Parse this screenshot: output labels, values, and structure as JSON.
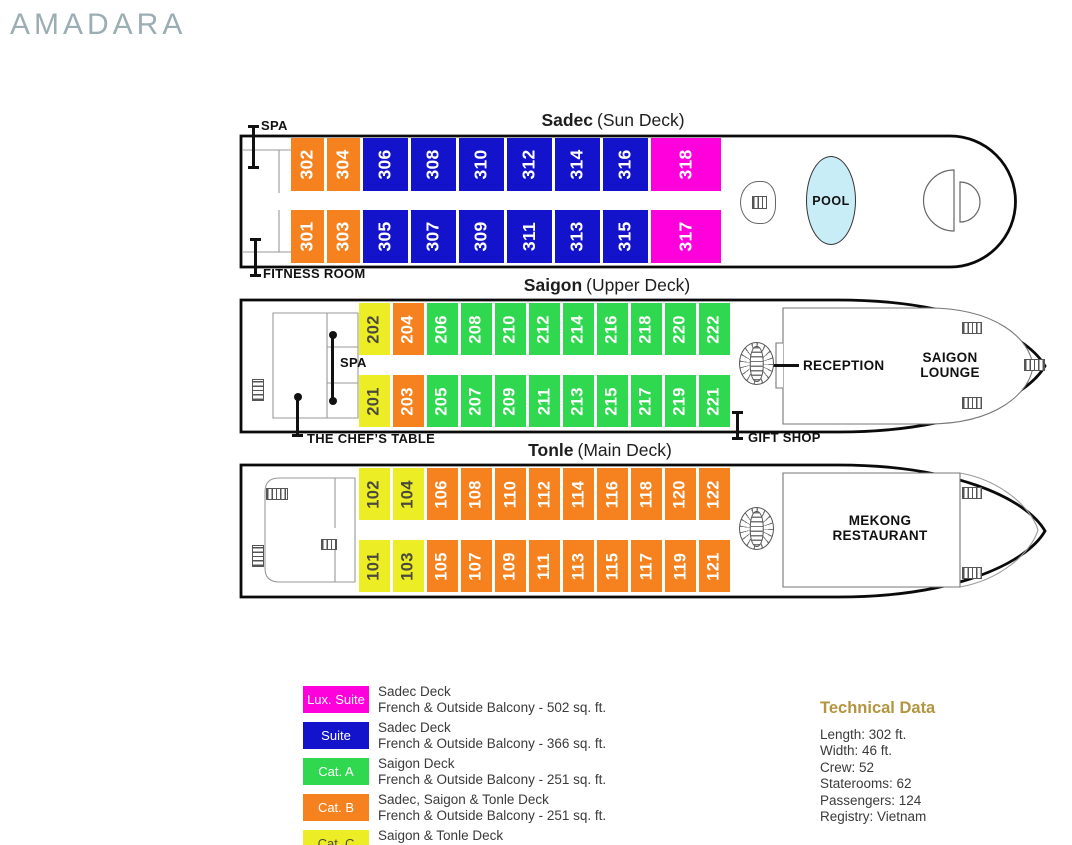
{
  "logo": "AMADARA",
  "colors": {
    "lux": "#FF00DC",
    "suite": "#1313CB",
    "catA": "#30D84F",
    "catB": "#F5821F",
    "catC": "#EDED26",
    "catCtext": "#4A4A3C",
    "pool": "#C9EDF6",
    "logo": "#9BAEB4",
    "gold": "#B3953F"
  },
  "icons": {
    "ladder": "striped-rect-stairs",
    "spiral_staircase": "radial-striped-circle",
    "pool_shape": "ellipse"
  },
  "decks": [
    {
      "name": "Sadec",
      "subtitle": "(Sun Deck)",
      "rooms_top": [
        {
          "num": "302",
          "cat": "catB"
        },
        {
          "num": "304",
          "cat": "catB"
        },
        {
          "num": "306",
          "cat": "suite"
        },
        {
          "num": "308",
          "cat": "suite"
        },
        {
          "num": "310",
          "cat": "suite"
        },
        {
          "num": "312",
          "cat": "suite"
        },
        {
          "num": "314",
          "cat": "suite"
        },
        {
          "num": "316",
          "cat": "suite"
        },
        {
          "num": "318",
          "cat": "lux"
        }
      ],
      "rooms_bottom": [
        {
          "num": "301",
          "cat": "catB"
        },
        {
          "num": "303",
          "cat": "catB"
        },
        {
          "num": "305",
          "cat": "suite"
        },
        {
          "num": "307",
          "cat": "suite"
        },
        {
          "num": "309",
          "cat": "suite"
        },
        {
          "num": "311",
          "cat": "suite"
        },
        {
          "num": "313",
          "cat": "suite"
        },
        {
          "num": "315",
          "cat": "suite"
        },
        {
          "num": "317",
          "cat": "lux"
        }
      ],
      "labels": {
        "spa": "SPA",
        "fitness": "FITNESS ROOM",
        "pool": "POOL"
      }
    },
    {
      "name": "Saigon",
      "subtitle": "(Upper Deck)",
      "rooms_top": [
        {
          "num": "202",
          "cat": "catC"
        },
        {
          "num": "204",
          "cat": "catB"
        },
        {
          "num": "206",
          "cat": "catA"
        },
        {
          "num": "208",
          "cat": "catA"
        },
        {
          "num": "210",
          "cat": "catA"
        },
        {
          "num": "212",
          "cat": "catA"
        },
        {
          "num": "214",
          "cat": "catA"
        },
        {
          "num": "216",
          "cat": "catA"
        },
        {
          "num": "218",
          "cat": "catA"
        },
        {
          "num": "220",
          "cat": "catA"
        },
        {
          "num": "222",
          "cat": "catA"
        }
      ],
      "rooms_bottom": [
        {
          "num": "201",
          "cat": "catC"
        },
        {
          "num": "203",
          "cat": "catB"
        },
        {
          "num": "205",
          "cat": "catA"
        },
        {
          "num": "207",
          "cat": "catA"
        },
        {
          "num": "209",
          "cat": "catA"
        },
        {
          "num": "211",
          "cat": "catA"
        },
        {
          "num": "213",
          "cat": "catA"
        },
        {
          "num": "215",
          "cat": "catA"
        },
        {
          "num": "217",
          "cat": "catA"
        },
        {
          "num": "219",
          "cat": "catA"
        },
        {
          "num": "221",
          "cat": "catA"
        }
      ],
      "labels": {
        "spa": "SPA",
        "chefs_table": "THE CHEF’S TABLE",
        "reception": "RECEPTION",
        "lounge_line1": "SAIGON",
        "lounge_line2": "LOUNGE",
        "gift_shop": "GIFT SHOP"
      }
    },
    {
      "name": "Tonle",
      "subtitle": "(Main Deck)",
      "rooms_top": [
        {
          "num": "102",
          "cat": "catC"
        },
        {
          "num": "104",
          "cat": "catC"
        },
        {
          "num": "106",
          "cat": "catB"
        },
        {
          "num": "108",
          "cat": "catB"
        },
        {
          "num": "110",
          "cat": "catB"
        },
        {
          "num": "112",
          "cat": "catB"
        },
        {
          "num": "114",
          "cat": "catB"
        },
        {
          "num": "116",
          "cat": "catB"
        },
        {
          "num": "118",
          "cat": "catB"
        },
        {
          "num": "120",
          "cat": "catB"
        },
        {
          "num": "122",
          "cat": "catB"
        }
      ],
      "rooms_bottom": [
        {
          "num": "101",
          "cat": "catC"
        },
        {
          "num": "103",
          "cat": "catC"
        },
        {
          "num": "105",
          "cat": "catB"
        },
        {
          "num": "107",
          "cat": "catB"
        },
        {
          "num": "109",
          "cat": "catB"
        },
        {
          "num": "111",
          "cat": "catB"
        },
        {
          "num": "113",
          "cat": "catB"
        },
        {
          "num": "115",
          "cat": "catB"
        },
        {
          "num": "117",
          "cat": "catB"
        },
        {
          "num": "119",
          "cat": "catB"
        },
        {
          "num": "121",
          "cat": "catB"
        }
      ],
      "labels": {
        "restaurant_line1": "MEKONG",
        "restaurant_line2": "RESTAURANT"
      }
    }
  ],
  "legend": [
    {
      "label": "Lux. Suite",
      "cat": "lux",
      "deck": "Sadec Deck",
      "detail": "French & Outside Balcony -  502 sq. ft."
    },
    {
      "label": "Suite",
      "cat": "suite",
      "deck": "Sadec Deck",
      "detail": "French & Outside Balcony - 366 sq. ft."
    },
    {
      "label": "Cat. A",
      "cat": "catA",
      "deck": "Saigon Deck",
      "detail": "French & Outside Balcony - 251 sq. ft."
    },
    {
      "label": "Cat. B",
      "cat": "catB",
      "deck": "Sadec, Saigon & Tonle Deck",
      "detail": "French & Outside Balcony - 251 sq. ft."
    },
    {
      "label": "Cat. C",
      "cat": "catC",
      "deck": "Saigon & Tonle Deck",
      "detail": "French & Outside Balcony - 251 sq. ft."
    }
  ],
  "technical": {
    "title": "Technical Data",
    "rows": [
      "Length: 302 ft.",
      "Width: 46 ft.",
      "Crew: 52",
      "Staterooms: 62",
      "Passengers: 124",
      "Registry: Vietnam"
    ]
  }
}
